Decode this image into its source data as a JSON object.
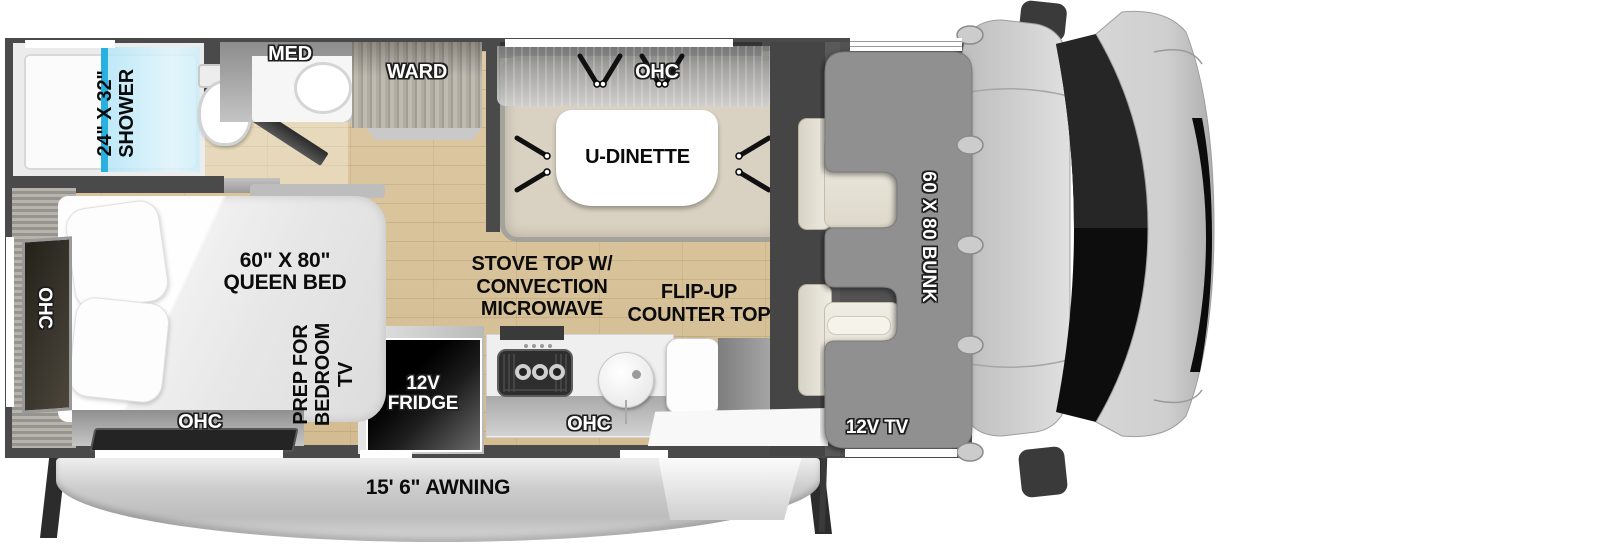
{
  "labels": {
    "shower": "24\" X 32\"\nSHOWER",
    "med": "MED",
    "ward": "WARD",
    "dinette_ohc": "OHC",
    "dinette": "U-DINETTE",
    "stove": "STOVE TOP W/\nCONVECTION\nMICROWAVE",
    "flip_up": "FLIP-UP\nCOUNTER TOP",
    "kitchen_ohc": "OHC",
    "fridge": "12V\nFRIDGE",
    "queen_bed": "60\" X 80\"\nQUEEN BED",
    "bedroom_ohc_side": "OHC",
    "bedroom_ohc_rear": "OHC",
    "tv_prep": "PREP FOR\nBEDROOM TV",
    "bunk": "60 X 80 BUNK",
    "cab_tv": "12V TV",
    "awning": "15' 6\" AWNING"
  },
  "colors": {
    "wall": "#4a4a4a",
    "floor_wood": "#d9c49c",
    "shower_glass": "#a5ddf3",
    "glass_edge": "#29b2e2",
    "bunk_overlay": "#909090",
    "awning": "#c9c9c9",
    "fridge": "#000000"
  }
}
